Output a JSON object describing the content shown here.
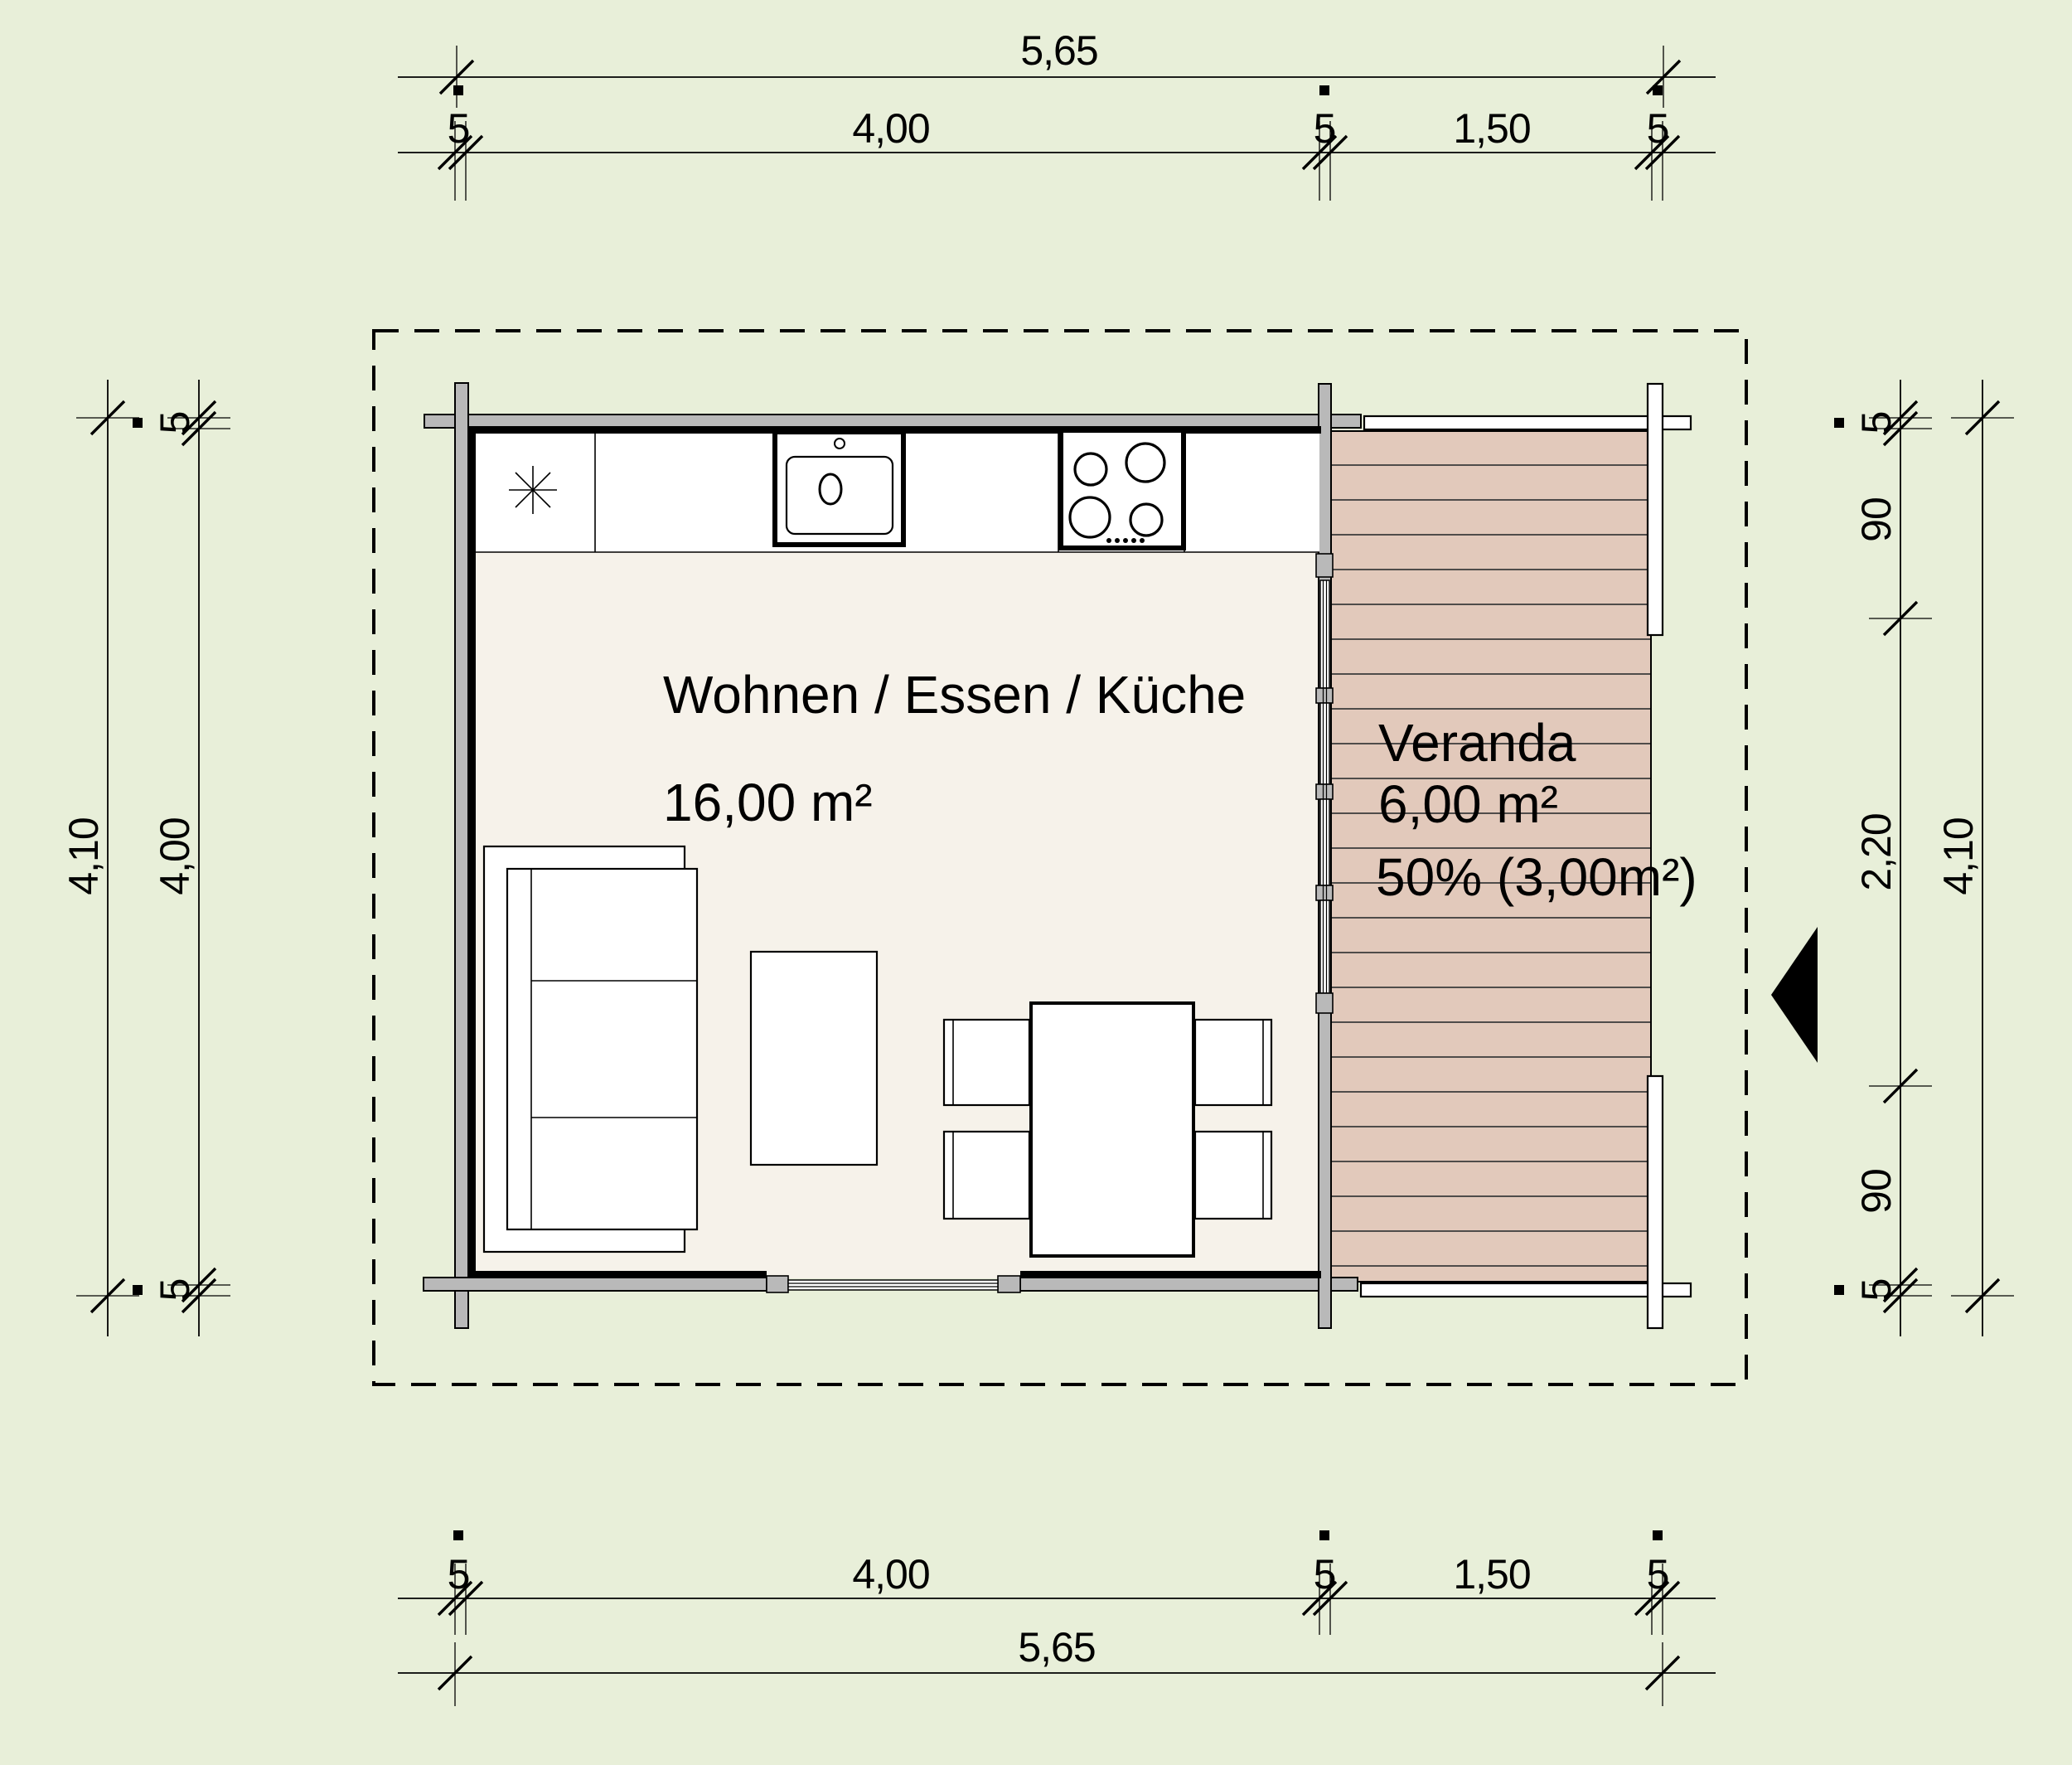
{
  "rooms": {
    "main": {
      "name": "Wohnen / Essen / Küche",
      "area": "16,00 m²"
    },
    "veranda": {
      "name": "Veranda",
      "area": "6,00 m²",
      "usable": "50% (3,00m²)"
    }
  },
  "dims": {
    "top": {
      "total": "5,65",
      "segments": [
        "5",
        "4,00",
        "5",
        "1,50",
        "5"
      ]
    },
    "bottom": {
      "total": "5,65",
      "segments": [
        "5",
        "4,00",
        "5",
        "1,50",
        "5"
      ]
    },
    "left": {
      "total": "4,10",
      "segments": [
        "5",
        "4,00",
        "5"
      ]
    },
    "right": {
      "total": "4,10",
      "segments": [
        "5",
        "90",
        "2,20",
        "90",
        "5"
      ]
    }
  },
  "symbols": {
    "entrance_arrow": "solid-triangle-pointing-left",
    "kitchen_ceiling_symbol": "asterisk-star",
    "roof_outline": "dashed-rectangle"
  },
  "colors": {
    "background": "#e8efd9",
    "floor": "#f6f2ea",
    "wall_fill": "#b9b9b9",
    "deck_fill": "#e2c9bb",
    "railing_fill": "#ffffff",
    "line": "#000000"
  }
}
